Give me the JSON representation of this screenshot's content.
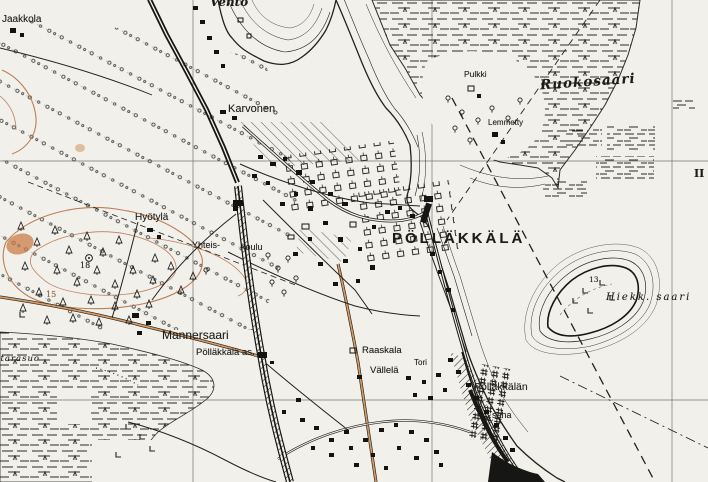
{
  "map": {
    "sheet_numeral": "II",
    "colors": {
      "paper": "#f2f0ea",
      "ink": "#1d1c19",
      "contour_brown": "#b5734a",
      "road_orange": "#d49a63"
    }
  },
  "labels": {
    "jaakkola": "Jaakkola",
    "vento": "Vento",
    "karvonen": "Karvonen",
    "pulkki": "Pulkki",
    "ruokosaari": "Ruokosaari",
    "lemmetty": "Lemmetty",
    "hyotyla": "Hyötylä",
    "yhteis": "Yhteis-",
    "koulu": "koulu",
    "pollakkala": "PÖLLÄKKÄLÄ",
    "mannersaari": "Mannersaari",
    "pollakkala_as": "Pölläkkälä as.",
    "raaskala": "Raaskala",
    "vallela": "Vällelä",
    "tori": "Tori",
    "pollakkalan": "Pölläkkälän",
    "saha": "saha",
    "hiekkasaari": "Hiekk. saari",
    "marsh_name": "ntäräsuo",
    "sheet_ii": "II",
    "spot_18": "18",
    "spot_15": "15",
    "spot_13": "13"
  }
}
